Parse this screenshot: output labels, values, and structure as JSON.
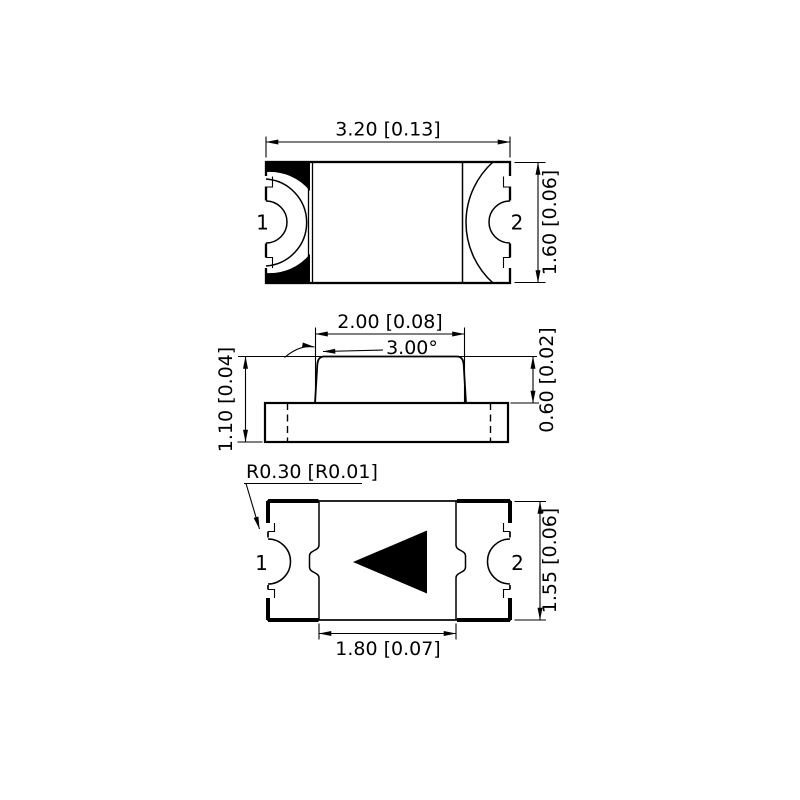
{
  "colors": {
    "ink": "#000000",
    "paper": "#ffffff"
  },
  "views": {
    "top": {
      "dim_width": "3.20 [0.13]",
      "dim_height": "1.60 [0.06]",
      "pin_left": "1",
      "pin_right": "2"
    },
    "side": {
      "dim_top_width": "2.00 [0.08]",
      "dim_draft_angle": "3.00°",
      "dim_total_height": "1.10 [0.04]",
      "dim_body_height": "0.60 [0.02]"
    },
    "bottom": {
      "callout_corner_radius": "R0.30 [R0.01]",
      "dim_height": "1.55 [0.06]",
      "dim_pad_width": "1.80 [0.07]",
      "pin_left": "1",
      "pin_right": "2"
    }
  }
}
